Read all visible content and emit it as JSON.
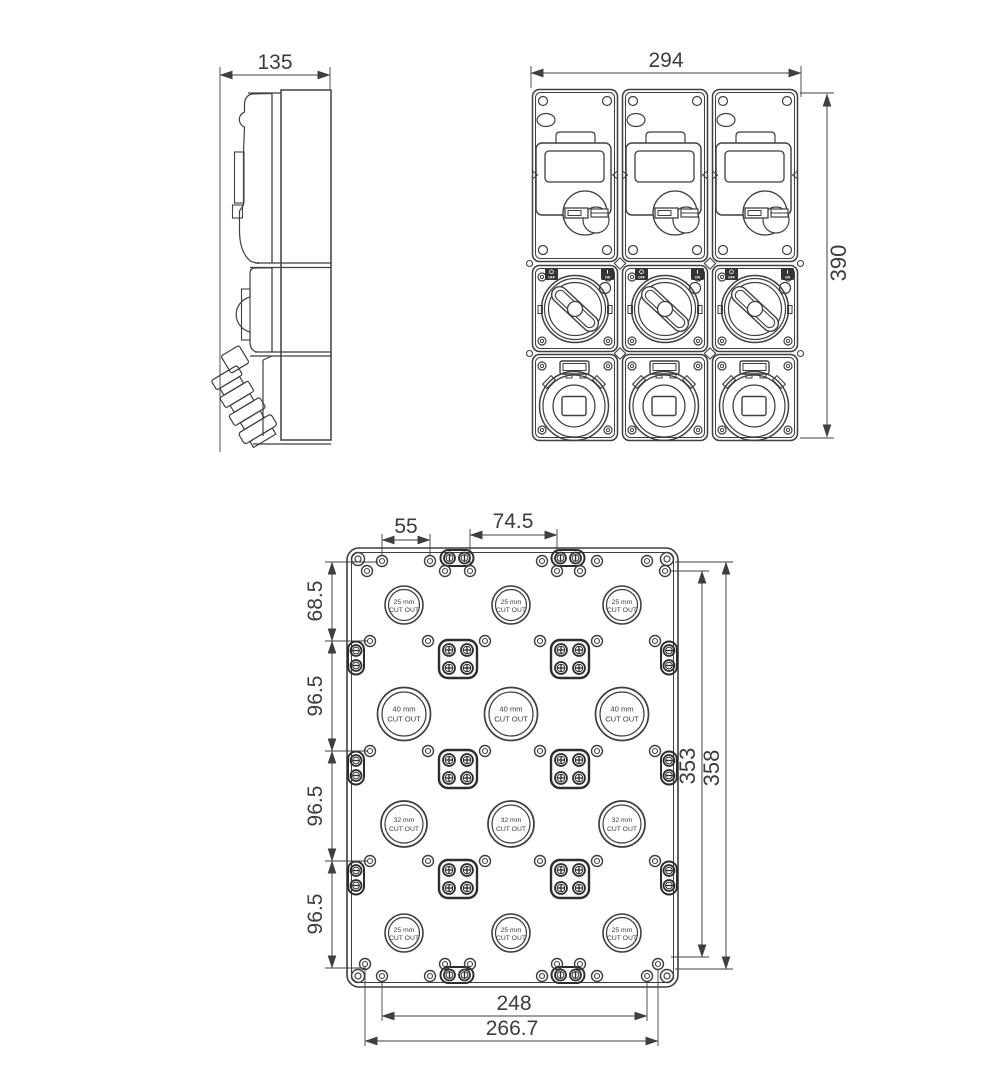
{
  "drawing": {
    "side_view": {
      "width_dim": "135"
    },
    "front_view": {
      "width_dim": "294",
      "height_dim": "390",
      "switch": {
        "off": "OFF",
        "on": "ON"
      }
    },
    "plate_view": {
      "top_dims": {
        "left": "55",
        "middle": "74.5"
      },
      "left_dims": [
        "68.5",
        "96.5",
        "96.5",
        "96.5"
      ],
      "right_dims": {
        "inner": "353",
        "outer": "358"
      },
      "bottom_dims": {
        "inner": "248",
        "outer": "266.7"
      },
      "cutout_rows": [
        {
          "size": "25 mm",
          "label": "CUT OUT"
        },
        {
          "size": "40 mm",
          "label": "CUT OUT"
        },
        {
          "size": "32 mm",
          "label": "CUT OUT"
        },
        {
          "size": "25 mm",
          "label": "CUT OUT"
        }
      ]
    },
    "colors": {
      "line": "#3f3f3f",
      "bold_line": "#2d2d2d",
      "text": "#3c3c3c",
      "bg": "#ffffff"
    }
  }
}
